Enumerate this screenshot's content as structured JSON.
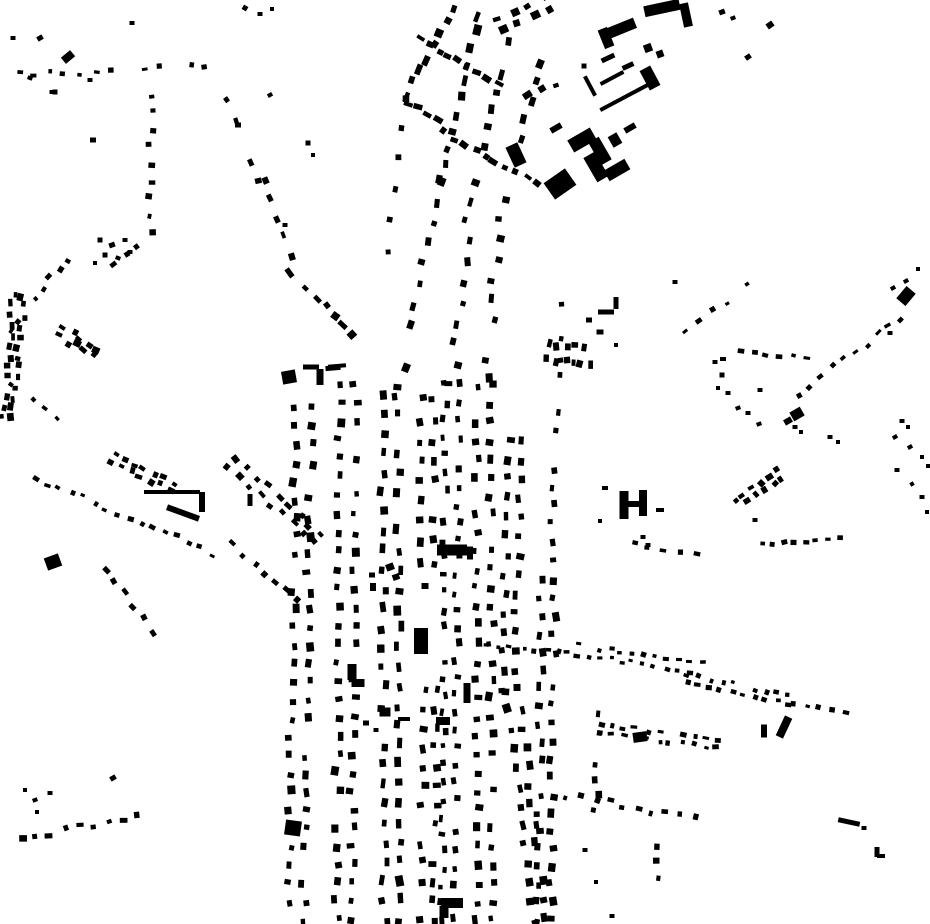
{
  "map": {
    "kind": "figure-ground-building-footprint-map",
    "width": 930,
    "height": 924,
    "colors": {
      "background": "#ffffff",
      "building": "#000000"
    },
    "seed": 7,
    "street_fields": [
      "x1",
      "y1",
      "x2",
      "y2",
      "count",
      "w",
      "h",
      "rows",
      "gap",
      "jitter"
    ],
    "streets": [
      [
        478,
        15,
        440,
        180,
        11,
        8,
        6,
        1,
        0,
        3
      ],
      [
        440,
        180,
        400,
        390,
        11,
        7,
        6,
        1,
        0,
        4
      ],
      [
        510,
        40,
        470,
        200,
        10,
        8,
        6,
        1,
        0,
        3
      ],
      [
        470,
        200,
        452,
        385,
        10,
        7,
        6,
        1,
        0,
        4
      ],
      [
        540,
        62,
        500,
        220,
        9,
        8,
        6,
        1,
        0,
        3
      ],
      [
        500,
        220,
        486,
        380,
        9,
        7,
        6,
        1,
        0,
        4
      ],
      [
        405,
        95,
        452,
        8,
        8,
        8,
        6,
        1,
        0,
        3
      ],
      [
        403,
        98,
        385,
        250,
        6,
        6,
        5,
        1,
        0,
        4
      ],
      [
        400,
        100,
        438,
        118,
        5,
        7,
        5,
        1,
        0,
        2
      ],
      [
        444,
        133,
        488,
        156,
        5,
        7,
        5,
        1,
        0,
        2
      ],
      [
        495,
        162,
        537,
        184,
        5,
        7,
        5,
        1,
        0,
        2
      ],
      [
        455,
        60,
        500,
        86,
        5,
        7,
        5,
        1,
        0,
        2
      ],
      [
        420,
        37,
        450,
        56,
        4,
        7,
        5,
        1,
        0,
        2
      ],
      [
        500,
        26,
        548,
        4,
        4,
        8,
        6,
        2,
        12,
        2
      ],
      [
        528,
        96,
        556,
        84,
        3,
        7,
        5,
        1,
        0,
        2
      ],
      [
        560,
        285,
        552,
        560,
        16,
        6,
        5,
        1,
        0,
        3
      ],
      [
        304,
        390,
        296,
        920,
        30,
        7,
        6,
        2,
        15,
        3
      ],
      [
        348,
        385,
        344,
        920,
        30,
        7,
        6,
        2,
        15,
        3
      ],
      [
        390,
        395,
        392,
        920,
        28,
        8,
        6,
        2,
        15,
        3
      ],
      [
        427,
        400,
        428,
        562,
        9,
        7,
        6,
        2,
        12,
        3
      ],
      [
        430,
        690,
        428,
        920,
        13,
        7,
        6,
        2,
        12,
        3
      ],
      [
        452,
        385,
        448,
        920,
        32,
        6,
        5,
        2,
        13,
        3
      ],
      [
        484,
        385,
        484,
        920,
        30,
        7,
        6,
        2,
        15,
        3
      ],
      [
        516,
        440,
        508,
        690,
        14,
        7,
        6,
        2,
        13,
        3
      ],
      [
        512,
        690,
        540,
        920,
        13,
        7,
        6,
        2,
        13,
        3
      ],
      [
        548,
        580,
        544,
        920,
        20,
        7,
        6,
        2,
        13,
        3
      ],
      [
        600,
        700,
        596,
        812,
        8,
        6,
        5,
        1,
        0,
        3
      ],
      [
        655,
        845,
        660,
        910,
        5,
        6,
        5,
        1,
        0,
        3
      ],
      [
        568,
        795,
        695,
        818,
        10,
        5,
        5,
        1,
        0,
        4
      ],
      [
        548,
        344,
        586,
        347,
        5,
        5,
        7,
        1,
        0,
        2
      ],
      [
        548,
        360,
        590,
        364,
        6,
        5,
        7,
        1,
        0,
        2
      ],
      [
        485,
        645,
        560,
        652,
        7,
        5,
        4,
        1,
        0,
        2
      ],
      [
        282,
        262,
        352,
        332,
        9,
        8,
        6,
        1,
        0,
        3
      ],
      [
        225,
        100,
        262,
        180,
        5,
        6,
        5,
        1,
        0,
        4
      ],
      [
        262,
        180,
        292,
        255,
        5,
        6,
        5,
        1,
        0,
        4
      ],
      [
        152,
        95,
        150,
        232,
        9,
        5,
        5,
        1,
        0,
        3
      ],
      [
        148,
        235,
        112,
        262,
        4,
        6,
        5,
        1,
        0,
        3
      ],
      [
        18,
        295,
        8,
        418,
        13,
        6,
        5,
        2,
        10,
        4
      ],
      [
        75,
        248,
        8,
        330,
        9,
        5,
        4,
        1,
        0,
        3
      ],
      [
        62,
        332,
        95,
        352,
        5,
        6,
        5,
        2,
        9,
        3
      ],
      [
        12,
        385,
        55,
        418,
        5,
        5,
        4,
        1,
        0,
        3
      ],
      [
        18,
        75,
        205,
        66,
        13,
        5,
        4,
        1,
        0,
        3
      ],
      [
        35,
        478,
        212,
        553,
        16,
        5,
        4,
        1,
        0,
        3
      ],
      [
        112,
        458,
        172,
        486,
        7,
        6,
        5,
        2,
        8,
        2
      ],
      [
        232,
        462,
        318,
        540,
        9,
        6,
        5,
        2,
        10,
        3
      ],
      [
        105,
        570,
        163,
        645,
        7,
        6,
        5,
        1,
        0,
        3
      ],
      [
        232,
        545,
        298,
        602,
        7,
        6,
        5,
        1,
        0,
        3
      ],
      [
        22,
        838,
        135,
        816,
        9,
        6,
        5,
        1,
        0,
        3
      ],
      [
        763,
        543,
        838,
        539,
        8,
        5,
        4,
        1,
        0,
        2
      ],
      [
        737,
        505,
        778,
        474,
        6,
        6,
        5,
        2,
        9,
        2
      ],
      [
        633,
        545,
        697,
        552,
        5,
        5,
        4,
        1,
        0,
        3
      ],
      [
        565,
        648,
        700,
        668,
        13,
        5,
        4,
        2,
        9,
        2
      ],
      [
        688,
        678,
        788,
        700,
        10,
        5,
        4,
        2,
        8,
        2
      ],
      [
        793,
        702,
        845,
        713,
        5,
        5,
        4,
        1,
        0,
        2
      ],
      [
        600,
        728,
        718,
        744,
        11,
        5,
        4,
        2,
        8,
        2
      ],
      [
        798,
        393,
        902,
        318,
        10,
        5,
        4,
        1,
        0,
        3
      ],
      [
        742,
        350,
        805,
        360,
        6,
        5,
        4,
        1,
        0,
        3
      ],
      [
        688,
        332,
        748,
        283,
        6,
        5,
        4,
        1,
        0,
        3
      ]
    ],
    "block_fields": [
      "cx",
      "cy",
      "w",
      "h",
      "rot"
    ],
    "blocks": [
      [
        560,
        184,
        26,
        20,
        -35
      ],
      [
        516,
        155,
        13,
        22,
        -25
      ],
      [
        662,
        8,
        36,
        11,
        -12
      ],
      [
        686,
        15,
        9,
        24,
        -12
      ],
      [
        622,
        28,
        28,
        11,
        -22
      ],
      [
        606,
        38,
        10,
        20,
        -22
      ],
      [
        648,
        48,
        8,
        8,
        -20
      ],
      [
        660,
        54,
        7,
        7,
        -20
      ],
      [
        608,
        58,
        14,
        5,
        -25
      ],
      [
        628,
        66,
        12,
        5,
        -25
      ],
      [
        612,
        78,
        26,
        4,
        -28
      ],
      [
        590,
        86,
        4,
        22,
        -28
      ],
      [
        625,
        97,
        56,
        4,
        -28
      ],
      [
        650,
        78,
        12,
        22,
        -28
      ],
      [
        584,
        66,
        5,
        5,
        0
      ],
      [
        582,
        140,
        26,
        14,
        -30
      ],
      [
        600,
        151,
        12,
        26,
        -30
      ],
      [
        615,
        140,
        10,
        12,
        -30
      ],
      [
        596,
        167,
        13,
        28,
        -30
      ],
      [
        617,
        170,
        24,
        12,
        -30
      ],
      [
        630,
        128,
        12,
        6,
        -30
      ],
      [
        556,
        128,
        12,
        6,
        -30
      ],
      [
        421,
        641,
        14,
        26,
        0
      ],
      [
        452,
        550,
        30,
        11,
        0
      ],
      [
        470,
        553,
        6,
        13,
        0
      ],
      [
        289,
        377,
        14,
        13,
        -10
      ],
      [
        311,
        367,
        16,
        5,
        0
      ],
      [
        333,
        368,
        15,
        5,
        -5
      ],
      [
        320,
        377,
        7,
        16,
        0
      ],
      [
        172,
        492,
        56,
        4,
        0
      ],
      [
        202,
        502,
        6,
        20,
        0
      ],
      [
        183,
        513,
        34,
        6,
        20
      ],
      [
        250,
        500,
        5,
        12,
        0
      ],
      [
        624,
        505,
        9,
        28,
        0
      ],
      [
        643,
        503,
        8,
        26,
        0
      ],
      [
        634,
        504,
        12,
        6,
        0
      ],
      [
        660,
        510,
        8,
        4,
        0
      ],
      [
        797,
        414,
        12,
        10,
        -30
      ],
      [
        788,
        421,
        8,
        6,
        -30
      ],
      [
        293,
        828,
        16,
        15,
        8
      ],
      [
        452,
        903,
        22,
        10,
        0
      ],
      [
        444,
        912,
        9,
        12,
        0
      ],
      [
        640,
        737,
        14,
        10,
        -8
      ],
      [
        784,
        727,
        8,
        22,
        25
      ],
      [
        764,
        731,
        6,
        13,
        0
      ],
      [
        849,
        822,
        22,
        5,
        12
      ],
      [
        906,
        296,
        12,
        16,
        40
      ],
      [
        352,
        672,
        9,
        16,
        0
      ],
      [
        358,
        683,
        13,
        8,
        0
      ],
      [
        385,
        712,
        11,
        9,
        0
      ],
      [
        404,
        719,
        12,
        4,
        0
      ],
      [
        443,
        721,
        14,
        8,
        0
      ],
      [
        467,
        693,
        7,
        20,
        0
      ],
      [
        53,
        562,
        15,
        13,
        -20
      ],
      [
        68,
        57,
        12,
        8,
        -40
      ],
      [
        877,
        852,
        5,
        10,
        0
      ],
      [
        881,
        856,
        8,
        4,
        0
      ],
      [
        606,
        312,
        16,
        5,
        0
      ],
      [
        616,
        303,
        5,
        12,
        0
      ],
      [
        337,
        366,
        18,
        4,
        -5
      ]
    ],
    "scatter_fields": [
      "cx",
      "cy",
      "w",
      "h",
      "rot"
    ],
    "scatter": [
      [
        13,
        38,
        5,
        4,
        0
      ],
      [
        30,
        78,
        5,
        4,
        20
      ],
      [
        52,
        92,
        5,
        4,
        0
      ],
      [
        40,
        38,
        6,
        5,
        -30
      ],
      [
        90,
        80,
        5,
        4,
        0
      ],
      [
        55,
        92,
        5,
        5,
        0
      ],
      [
        132,
        23,
        5,
        4,
        0
      ],
      [
        245,
        8,
        5,
        5,
        30
      ],
      [
        260,
        14,
        5,
        4,
        0
      ],
      [
        272,
        9,
        4,
        4,
        0
      ],
      [
        238,
        125,
        6,
        5,
        0
      ],
      [
        270,
        95,
        5,
        4,
        -30
      ],
      [
        308,
        143,
        5,
        5,
        0
      ],
      [
        313,
        155,
        4,
        4,
        0
      ],
      [
        93,
        140,
        6,
        5,
        0
      ],
      [
        100,
        240,
        5,
        5,
        0
      ],
      [
        112,
        245,
        6,
        5,
        -20
      ],
      [
        125,
        240,
        5,
        4,
        0
      ],
      [
        105,
        255,
        5,
        5,
        0
      ],
      [
        118,
        258,
        5,
        4,
        20
      ],
      [
        130,
        252,
        5,
        4,
        0
      ],
      [
        95,
        263,
        4,
        4,
        0
      ],
      [
        285,
        225,
        5,
        4,
        0
      ],
      [
        722,
        12,
        6,
        5,
        -20
      ],
      [
        733,
        18,
        5,
        4,
        -20
      ],
      [
        748,
        57,
        6,
        5,
        -35
      ],
      [
        770,
        25,
        7,
        6,
        -35
      ],
      [
        675,
        282,
        5,
        4,
        0
      ],
      [
        589,
        320,
        6,
        5,
        0
      ],
      [
        600,
        332,
        7,
        5,
        0
      ],
      [
        616,
        345,
        4,
        4,
        0
      ],
      [
        643,
        537,
        5,
        4,
        0
      ],
      [
        648,
        545,
        5,
        4,
        0
      ],
      [
        755,
        520,
        5,
        4,
        0
      ],
      [
        738,
        408,
        5,
        4,
        -20
      ],
      [
        748,
        413,
        5,
        4,
        0
      ],
      [
        759,
        424,
        5,
        4,
        -20
      ],
      [
        830,
        437,
        5,
        4,
        0
      ],
      [
        838,
        442,
        4,
        4,
        0
      ],
      [
        902,
        421,
        5,
        4,
        0
      ],
      [
        908,
        427,
        4,
        4,
        0
      ],
      [
        895,
        437,
        5,
        4,
        -30
      ],
      [
        910,
        447,
        5,
        4,
        -30
      ],
      [
        922,
        457,
        4,
        4,
        0
      ],
      [
        928,
        466,
        4,
        4,
        0
      ],
      [
        897,
        470,
        5,
        4,
        0
      ],
      [
        912,
        484,
        4,
        4,
        -30
      ],
      [
        922,
        497,
        5,
        4,
        0
      ],
      [
        927,
        512,
        4,
        4,
        0
      ],
      [
        890,
        333,
        5,
        4,
        0
      ],
      [
        723,
        359,
        6,
        4,
        0
      ],
      [
        760,
        390,
        5,
        4,
        0
      ],
      [
        795,
        427,
        5,
        4,
        0
      ],
      [
        801,
        432,
        4,
        4,
        0
      ],
      [
        715,
        362,
        5,
        4,
        0
      ],
      [
        722,
        375,
        5,
        5,
        0
      ],
      [
        718,
        388,
        4,
        4,
        0
      ],
      [
        728,
        393,
        5,
        4,
        0
      ],
      [
        893,
        288,
        5,
        4,
        -30
      ],
      [
        906,
        281,
        5,
        4,
        -30
      ],
      [
        918,
        269,
        4,
        4,
        0
      ],
      [
        605,
        488,
        6,
        4,
        0
      ],
      [
        600,
        521,
        4,
        4,
        0
      ],
      [
        113,
        778,
        6,
        5,
        -30
      ],
      [
        50,
        793,
        5,
        4,
        0
      ],
      [
        25,
        790,
        4,
        4,
        0
      ],
      [
        35,
        800,
        5,
        4,
        -20
      ],
      [
        37,
        812,
        4,
        4,
        0
      ],
      [
        585,
        850,
        5,
        4,
        0
      ],
      [
        596,
        882,
        4,
        4,
        0
      ],
      [
        612,
        916,
        5,
        4,
        0
      ],
      [
        864,
        828,
        5,
        4,
        0
      ],
      [
        366,
        723,
        6,
        5,
        0
      ],
      [
        376,
        730,
        5,
        4,
        0
      ],
      [
        390,
        567,
        8,
        7,
        -20
      ],
      [
        396,
        577,
        7,
        6,
        -20
      ],
      [
        372,
        575,
        6,
        5,
        0
      ],
      [
        373,
        587,
        6,
        8,
        0
      ],
      [
        425,
        586,
        7,
        6,
        0
      ]
    ]
  }
}
